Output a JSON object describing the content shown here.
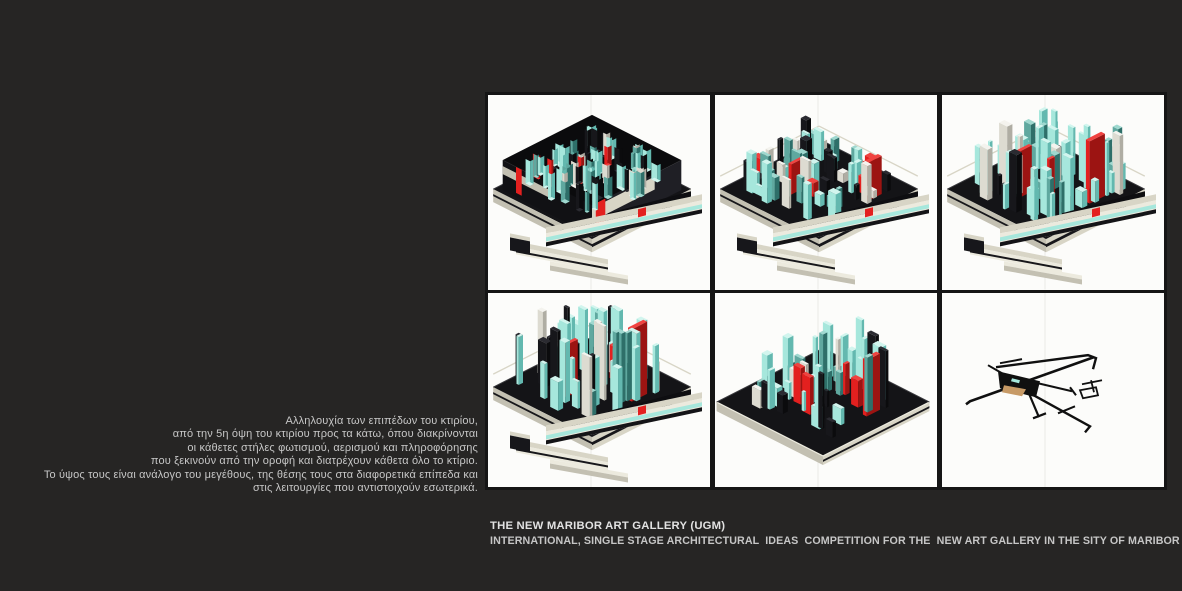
{
  "page": {
    "background": "#262524",
    "grid_gap_color": "#151515"
  },
  "caption": {
    "lines": [
      "Αλληλουχία των επιπέδων του κτιρίου,",
      "από την 5η όψη του κτιρίου προς τα κάτω, όπου διακρίνονται",
      "οι κάθετες στήλες φωτισμού, αερισμού και πληροφόρησης",
      "που ξεκινούν από την οροφή και διατρέχουν κάθετα όλο το κτίριο.",
      "Το ύψος τους είναι ανάλογο του μεγέθους, της θέσης τους στα διαφορετικά επίπεδα και",
      "στις λειτουργίες που αντιστοιχούν εσωτερικά."
    ]
  },
  "title_block": {
    "title": "THE NEW MARIBOR ART GALLERY (UGM)",
    "subtitle": "INTERNATIONAL, SINGLE STAGE ARCHITECTURAL  IDEAS  COMPETITION FOR THE  NEW ART GALLERY IN THE SITY OF MARIBOR IN SLOVENIA"
  },
  "gallery": {
    "panel_background": "#fcfcfa",
    "panels": [
      {
        "id": "axon-view-roof-level"
      },
      {
        "id": "axon-view-columns-low"
      },
      {
        "id": "axon-view-columns-mid"
      },
      {
        "id": "axon-view-columns-tall"
      },
      {
        "id": "axon-view-columns-slab"
      },
      {
        "id": "plan-skeleton-view"
      }
    ],
    "colors": {
      "hairline": "#eaeae6",
      "model_dark": "#141417",
      "model_black": "#0b0b0d",
      "dark": "#17171b",
      "dark_top": "#2b2b31",
      "dark_deep": "#0b0b0d",
      "cream": "#d8d5c6",
      "cream_light": "#eceade",
      "cream_dim": "#c3c0b2",
      "cyan_top": "#d2f5ee",
      "cyan": "#a6e7dc",
      "cyan_deep": "#63b8af",
      "teal_top": "#9fd8cf",
      "teal": "#5fa89f",
      "teal_deep": "#2e6f69",
      "red_top": "#f04340",
      "red": "#e3201f",
      "red_deep": "#9c1412",
      "white_top": "#f4f3ee",
      "white": "#dddbd1",
      "white_deep": "#afada3",
      "skeleton_ink": "#101010",
      "skeleton_tan": "#c79a66"
    }
  }
}
